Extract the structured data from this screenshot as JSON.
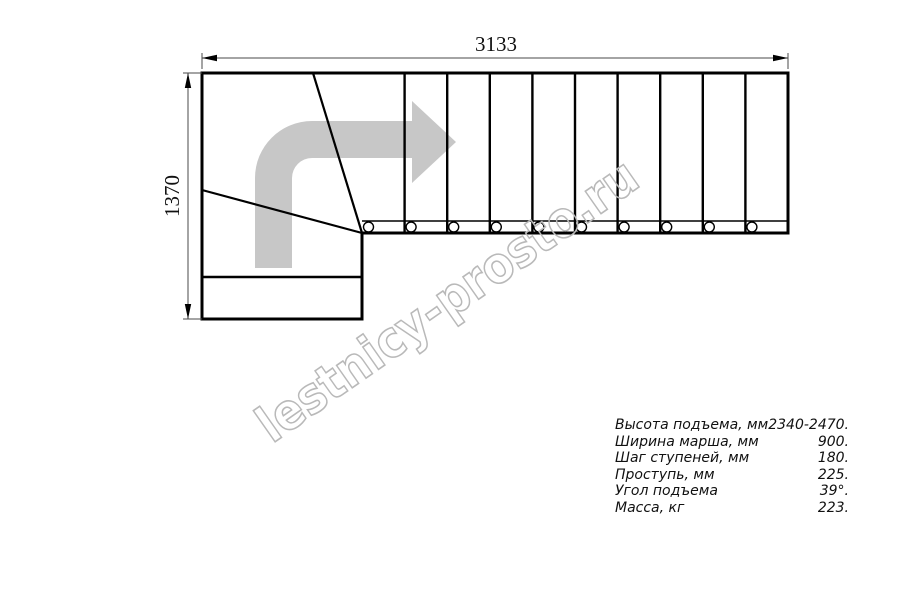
{
  "drawing": {
    "title": "staircase-plan-top-view",
    "dimensions": {
      "width_label": "3133",
      "height_label": "1370"
    },
    "watermark": "lestnicy-prosto.ru",
    "icons": {
      "direction_arrow": "curved-right-arrow"
    },
    "colors": {
      "line": "#000000",
      "dimension_line": "#4a4a4a",
      "arrow_fill": "#c7c7c7",
      "watermark_stroke": "#b9b9b9"
    },
    "step_count_straight_flight": 10,
    "tread_marker_count": 10
  },
  "specs": {
    "rows": [
      {
        "label": "Высота подъема, мм",
        "value": "2340-2470."
      },
      {
        "label": "Ширина марша, мм",
        "value": "900."
      },
      {
        "label": "Шаг ступеней, мм",
        "value": "180."
      },
      {
        "label": "Проступь, мм",
        "value": "225."
      },
      {
        "label": "Угол подъема",
        "value": "39°."
      },
      {
        "label": "Масса, кг",
        "value": "223."
      }
    ]
  }
}
